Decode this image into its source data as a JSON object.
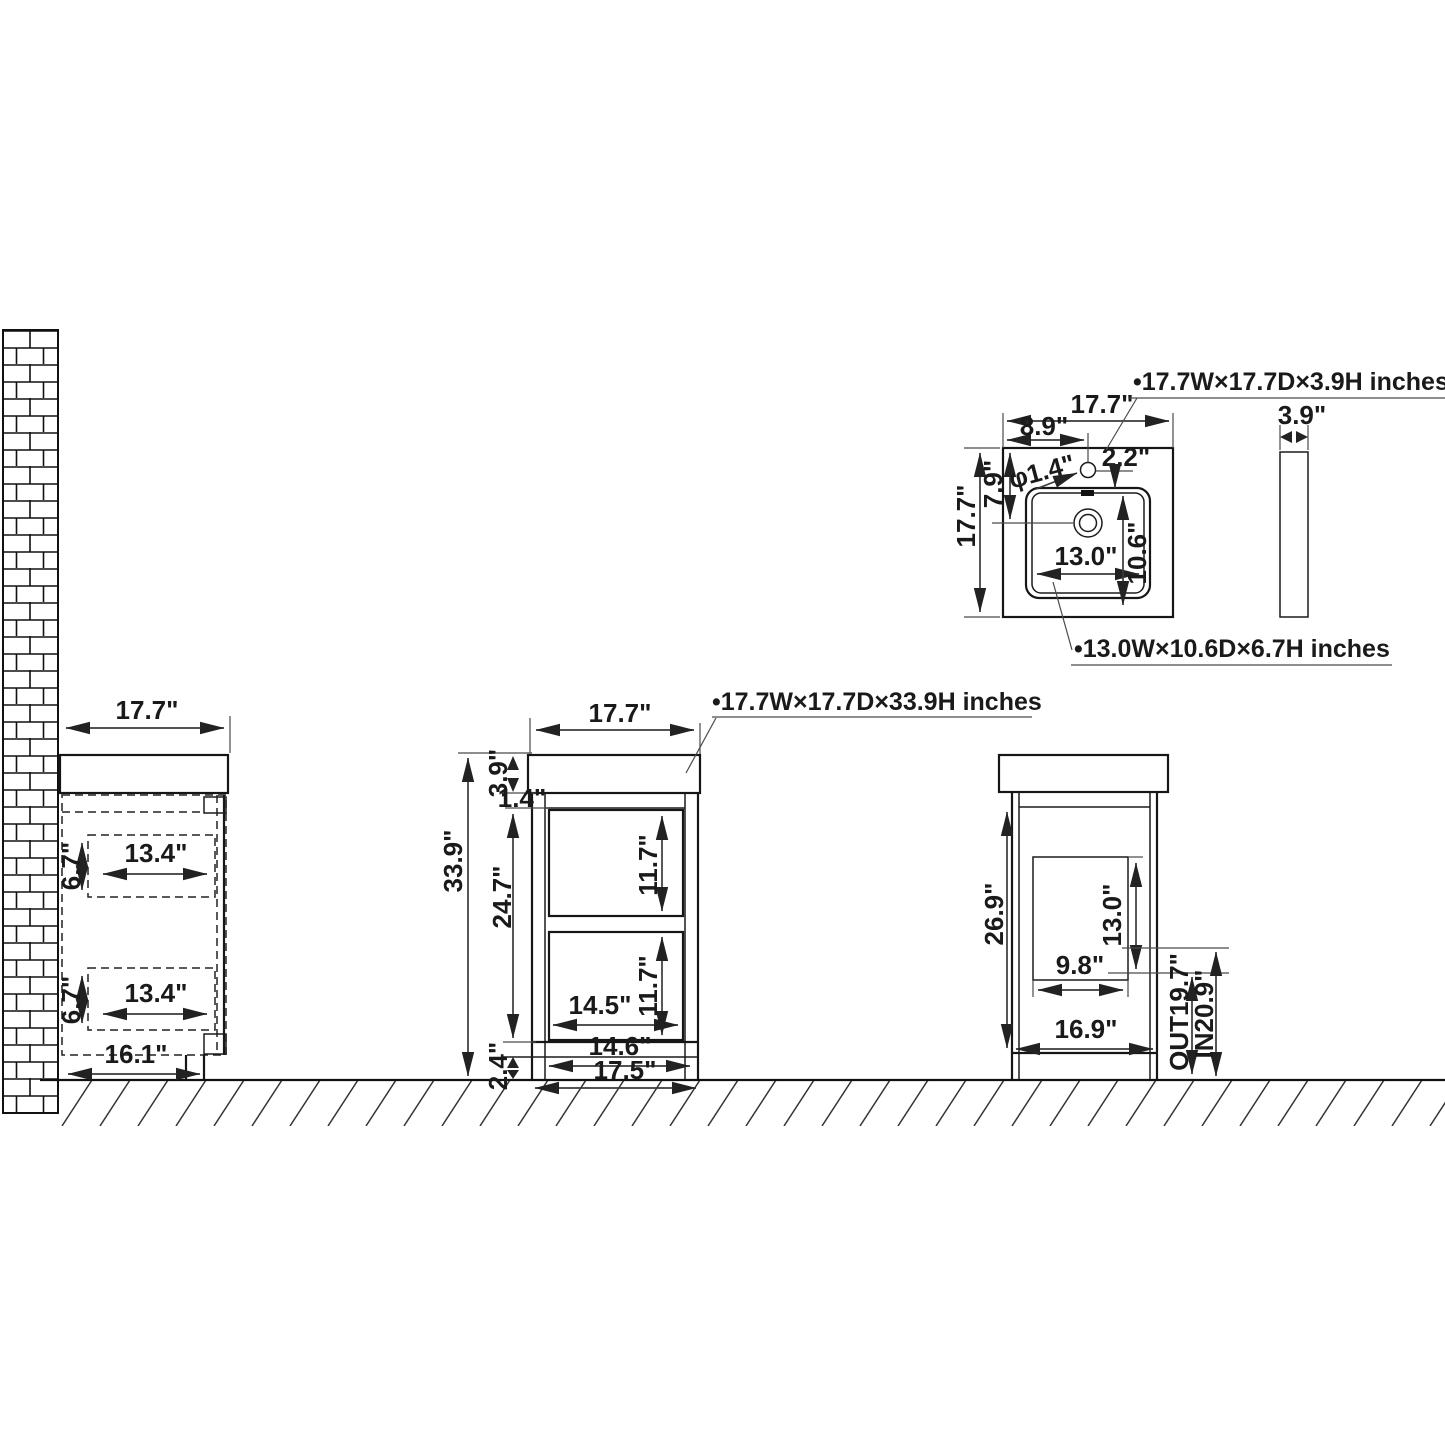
{
  "specs": {
    "sink": "•17.7W×17.7D×3.9H inches",
    "basin": "•13.0W×10.6D×6.7H inches",
    "vanity": "•17.7W×17.7D×33.9H inches"
  },
  "sink_top_view": {
    "width": "17.7\"",
    "faucet_offset": "8.9\"",
    "depth": "17.7\"",
    "drain_offset": "7.9\"",
    "faucet_diameter": "φ1.4\"",
    "faucet_gap": "2.2\"",
    "basin_width": "13.0\"",
    "basin_depth": "10.6\""
  },
  "slab_view": {
    "thickness": "3.9\""
  },
  "side_view": {
    "depth": "17.7\"",
    "drawer1_height": "6.7\"",
    "drawer1_depth": "13.4\"",
    "drawer2_height": "6.7\"",
    "drawer2_depth": "13.4\"",
    "base_depth": "16.1\""
  },
  "front_view": {
    "width": "17.7\"",
    "counter_thickness": "3.9\"",
    "frame_gap": "1.4\"",
    "total_height": "33.9\"",
    "body_height": "24.7\"",
    "drawer1_height": "11.7\"",
    "drawer2_height": "11.7\"",
    "drawer_width": "14.5\"",
    "inner_width": "14.6\"",
    "leg_height": "2.4\"",
    "base_width": "17.5\""
  },
  "back_view": {
    "height": "26.9\"",
    "cutout_height": "13.0\"",
    "cutout_width": "9.8\"",
    "width": "16.9\"",
    "drain_out": "OUT19.7\"",
    "water_in": "IN20.9\""
  }
}
